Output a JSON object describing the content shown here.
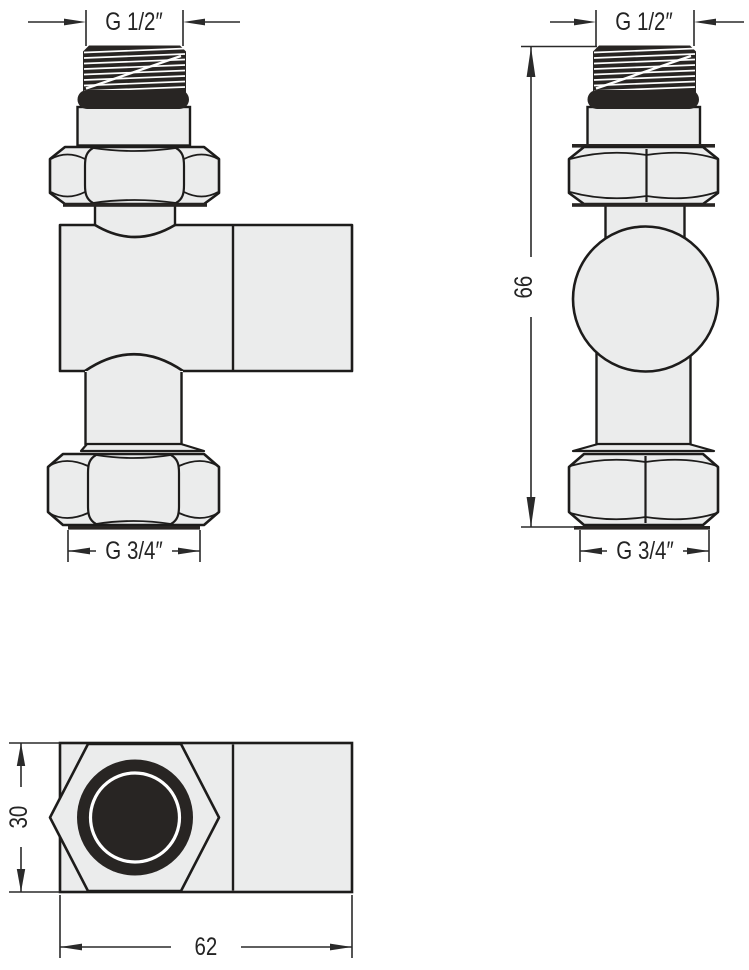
{
  "drawing": {
    "front_view": {
      "thread_top": "G 1/2″",
      "thread_bottom": "G 3/4″"
    },
    "side_view": {
      "thread_top": "G 1/2″",
      "thread_bottom": "G 3/4″",
      "height": "66"
    },
    "top_view": {
      "depth": "30",
      "width": "62"
    },
    "colors": {
      "outline": "#1d1c1b",
      "body_fill": "#ebecec",
      "solid_black": "#282523",
      "dimension": "#2a2a2a"
    }
  }
}
